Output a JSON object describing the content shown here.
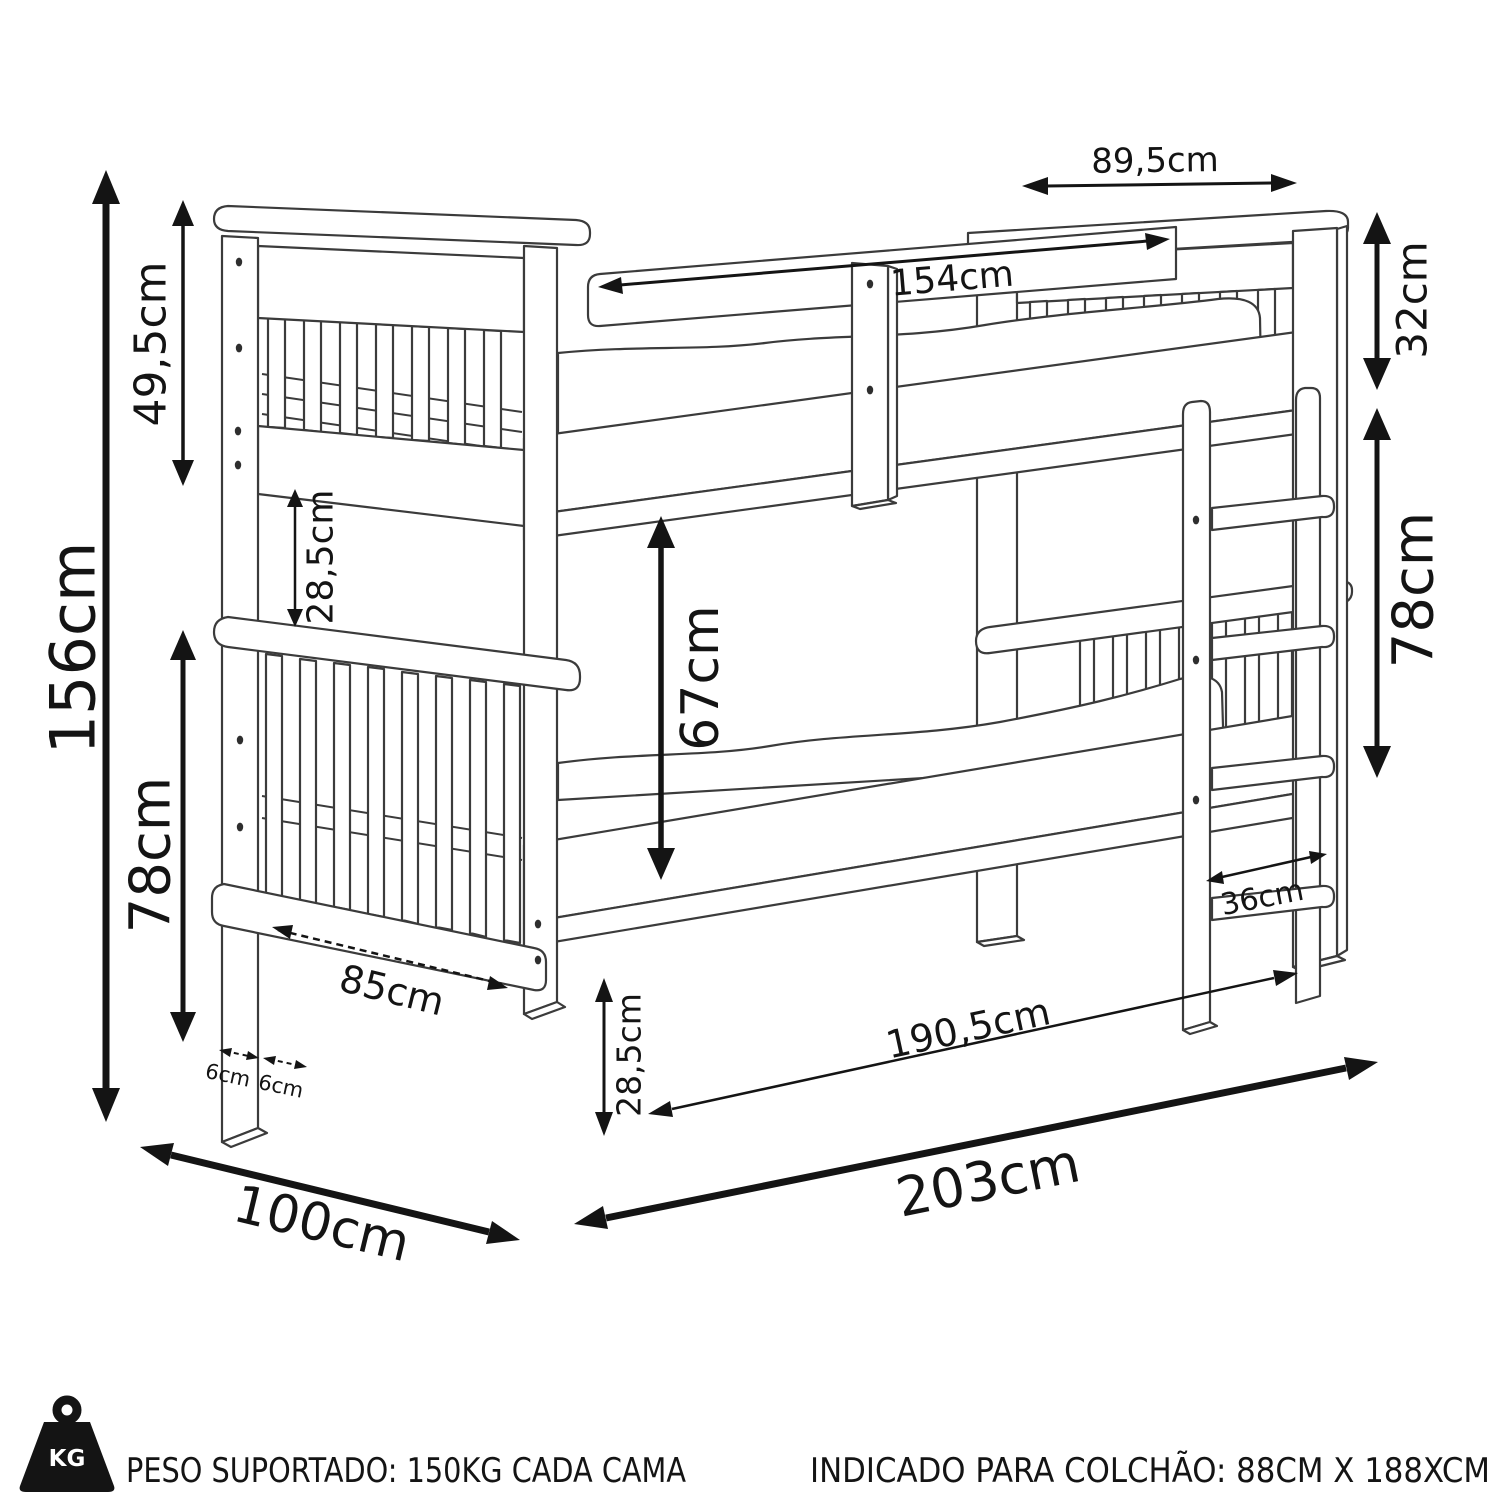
{
  "diagram": {
    "type": "furniture-dimension-diagram",
    "subject": "bunk bed technical drawing",
    "background": "#ffffff",
    "line_color": "#3b3b3b",
    "dimension_color": "#141414",
    "dimensions": {
      "total_height": "156cm",
      "upper_headboard_height": "49,5cm",
      "headboard_gap": "28,5cm",
      "lower_headboard_height": "78cm",
      "guard_rail_length": "154cm",
      "headboard_width": "89,5cm",
      "rail_to_mattress": "32cm",
      "ladder_height": "78cm",
      "bunk_clearance": "67cm",
      "ladder_width": "36cm",
      "leg_inner_span": "85cm",
      "front_leg_width": "6cm",
      "side_leg_depth": "6cm",
      "base_height": "28,5cm",
      "mattress_length": "190,5cm",
      "total_length": "203cm",
      "total_depth": "100cm"
    }
  },
  "footer": {
    "weight_badge": "KG",
    "supported_weight": "PESO SUPORTADO: 150KG CADA CAMA",
    "mattress_recommendation": "INDICADO PARA COLCHÃO: 88CM X 188XCM"
  }
}
